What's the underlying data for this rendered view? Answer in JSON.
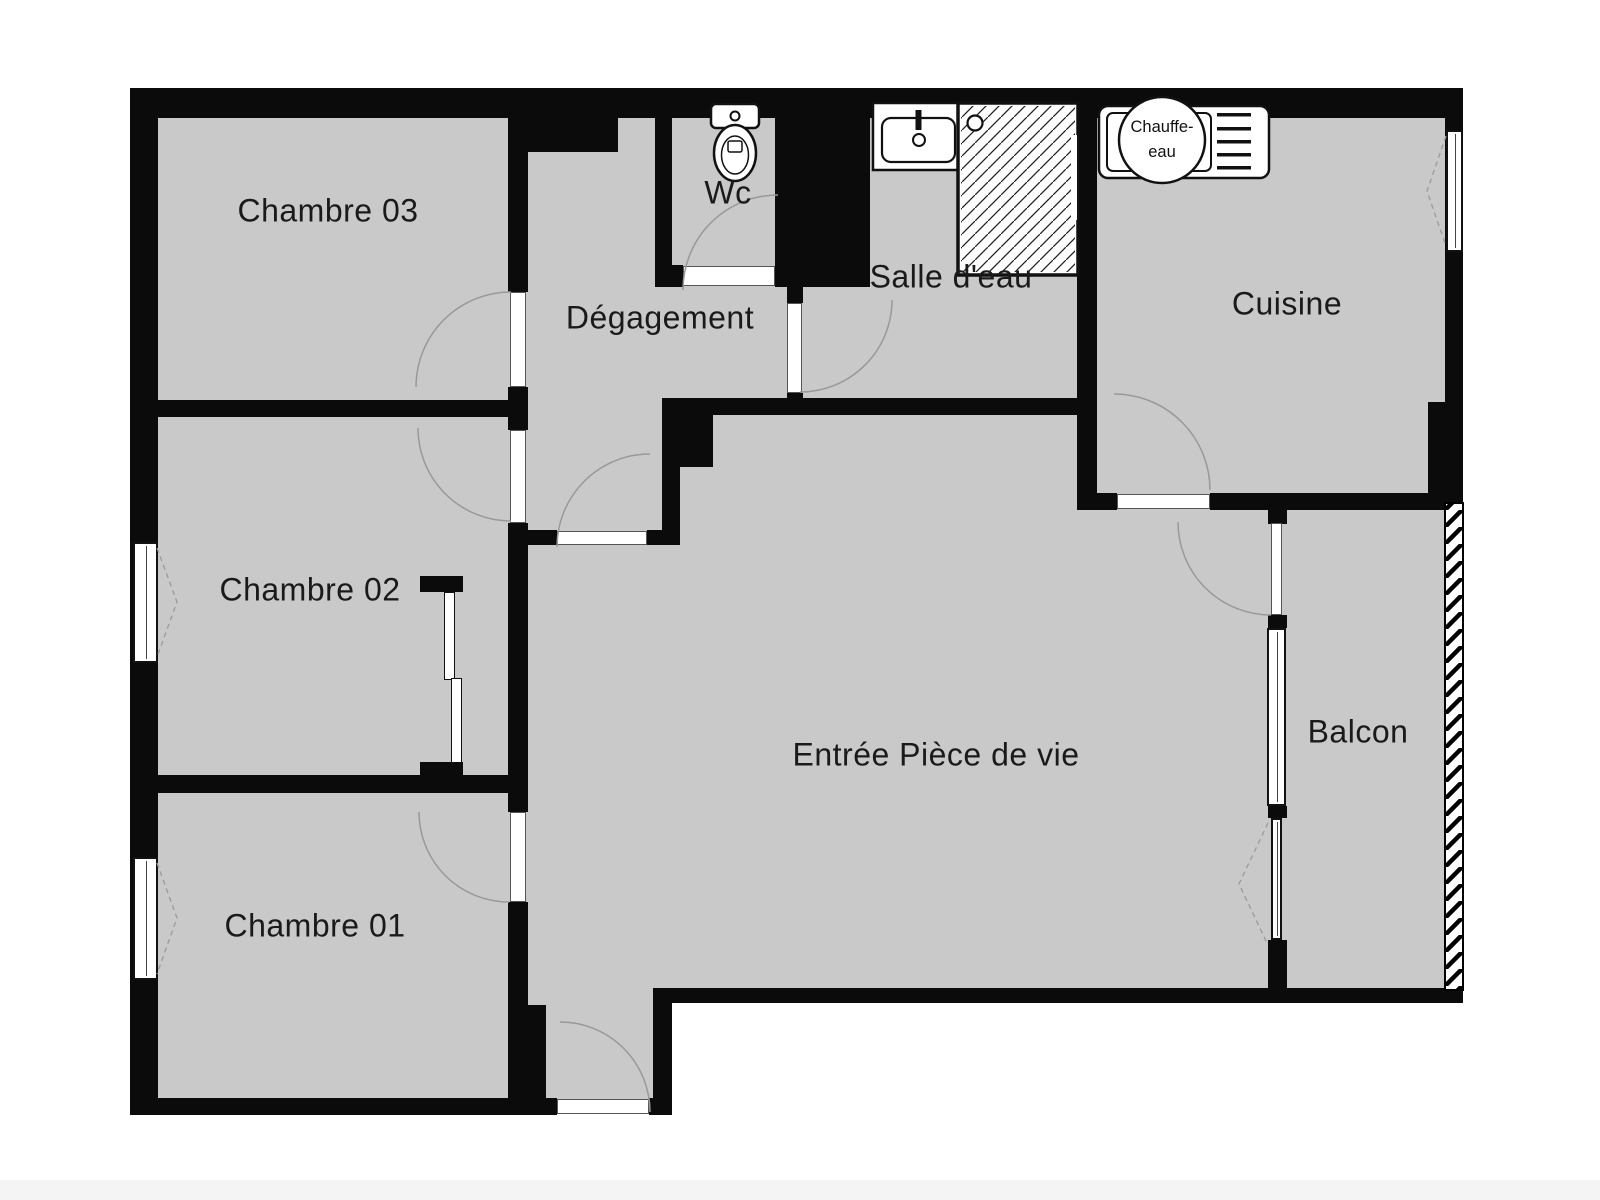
{
  "meta": {
    "type": "apartment-floor-plan"
  },
  "colors": {
    "floor": "#c9c9c9",
    "wall": "#0b0b0b",
    "window_fill": "#ffffff",
    "door_arc": "#999999",
    "label_text": "#1a1a1a"
  },
  "rooms": [
    {
      "id": "chambre-03",
      "label": "Chambre 03"
    },
    {
      "id": "chambre-02",
      "label": "Chambre 02"
    },
    {
      "id": "chambre-01",
      "label": "Chambre 01"
    },
    {
      "id": "degagement",
      "label": "Dégagement"
    },
    {
      "id": "wc",
      "label": "Wc"
    },
    {
      "id": "salle-d-eau",
      "label": "Salle d'eau"
    },
    {
      "id": "cuisine",
      "label": "Cuisine"
    },
    {
      "id": "entree-piece-de-vie",
      "label": "Entrée Pièce de vie"
    },
    {
      "id": "balcon",
      "label": "Balcon"
    }
  ],
  "fixtures": {
    "chauffe_eau": {
      "line1": "Chauffe-",
      "line2": "eau"
    },
    "icons": [
      "toilet-icon",
      "sink-icon",
      "shower-icon",
      "water-heater-icon",
      "kitchen-counter-icon",
      "balcony-railing"
    ]
  }
}
